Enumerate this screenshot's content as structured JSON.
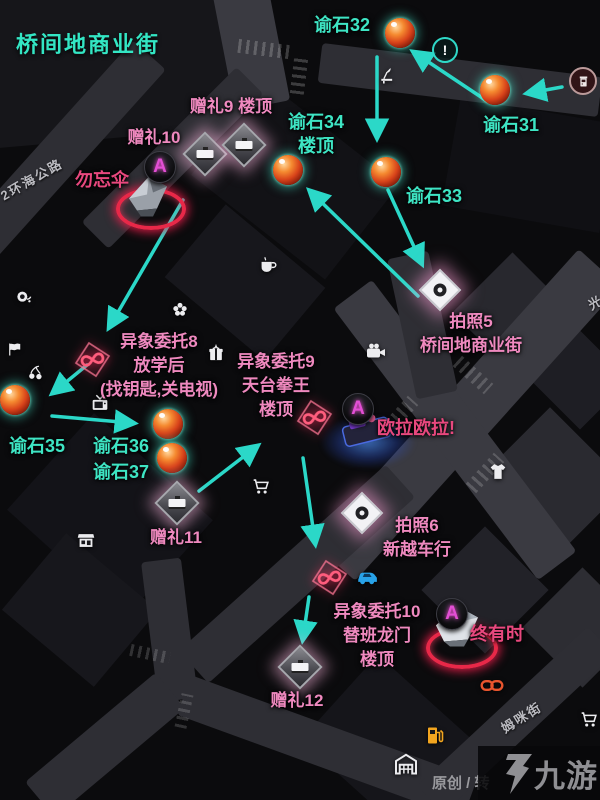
{
  "title": "桥间地商业街",
  "watermark": {
    "credit": "原创 / 转",
    "brand": "九游"
  },
  "colors": {
    "teal": "#3ee5c4",
    "pink": "#ef89bf",
    "rose": "#e8487e",
    "arrow": "#2bd8c8"
  },
  "street_names": [
    {
      "text": "2环海公路",
      "x": 32,
      "y": 180,
      "rotate": -30
    },
    {
      "text": "姆咪街",
      "x": 522,
      "y": 718,
      "rotate": -32
    },
    {
      "text": "光",
      "x": 596,
      "y": 303,
      "rotate": -30
    }
  ],
  "orb_markers": [
    {
      "lines": [
        "谕石31"
      ],
      "orb": {
        "x": 495,
        "y": 90
      },
      "label": {
        "x": 511,
        "y": 125
      }
    },
    {
      "lines": [
        "谕石32"
      ],
      "orb": {
        "x": 400,
        "y": 33
      },
      "label": {
        "x": 342,
        "y": 25
      }
    },
    {
      "lines": [
        "谕石33"
      ],
      "orb": {
        "x": 386,
        "y": 172
      },
      "label": {
        "x": 434,
        "y": 196
      }
    },
    {
      "lines": [
        "谕石34",
        "楼顶"
      ],
      "orb": {
        "x": 288,
        "y": 170
      },
      "label": {
        "x": 316,
        "y": 134
      }
    },
    {
      "lines": [
        "谕石35"
      ],
      "orb": {
        "x": 15,
        "y": 400
      },
      "label": {
        "x": 37,
        "y": 446
      }
    },
    {
      "lines": [
        "谕石36"
      ],
      "orb": {
        "x": 168,
        "y": 424
      },
      "label": {
        "x": 121,
        "y": 446
      }
    },
    {
      "lines": [
        "谕石37"
      ],
      "orb": {
        "x": 172,
        "y": 458
      },
      "label": {
        "x": 121,
        "y": 472
      }
    }
  ],
  "gift_markers": {
    "icons": [
      {
        "x": 205,
        "y": 154
      },
      {
        "x": 244,
        "y": 145
      },
      {
        "x": 177,
        "y": 503
      },
      {
        "x": 300,
        "y": 667
      }
    ],
    "labels": [
      {
        "lines": [
          "赠礼9 楼顶"
        ],
        "x": 231,
        "y": 107
      },
      {
        "lines": [
          "赠礼10"
        ],
        "x": 154,
        "y": 138
      },
      {
        "lines": [
          "赠礼11"
        ],
        "x": 176,
        "y": 538
      },
      {
        "lines": [
          "赠礼12"
        ],
        "x": 297,
        "y": 701
      }
    ]
  },
  "photo_markers": {
    "icons": [
      {
        "x": 440,
        "y": 290
      },
      {
        "x": 362,
        "y": 513
      }
    ],
    "labels": [
      {
        "lines": [
          "拍照5",
          "桥间地商业街"
        ],
        "x": 471,
        "y": 334
      },
      {
        "lines": [
          "拍照6",
          "新越车行"
        ],
        "x": 417,
        "y": 538
      }
    ]
  },
  "anomaly_markers": {
    "icons": [
      {
        "x": 93,
        "y": 362
      },
      {
        "x": 315,
        "y": 420
      },
      {
        "x": 330,
        "y": 580
      }
    ],
    "labels": [
      {
        "lines": [
          "异象委托8",
          "放学后",
          "(找钥匙,关电视)"
        ],
        "x": 159,
        "y": 366
      },
      {
        "lines": [
          "异象委托9",
          "天台拳王",
          "楼顶"
        ],
        "x": 276,
        "y": 386
      },
      {
        "lines": [
          "异象委托10",
          "替班龙门",
          "楼顶"
        ],
        "x": 377,
        "y": 636
      }
    ]
  },
  "characters": [
    {
      "name": "勿忘伞",
      "badge_letter": "A",
      "label": {
        "x": 102,
        "y": 180
      },
      "figure": "umbrella",
      "fig": {
        "x": 150,
        "y": 196
      },
      "badge": {
        "x": 160,
        "y": 167
      },
      "ring": {
        "x": 151,
        "y": 209,
        "w": 62,
        "h": 34,
        "kind": "red"
      }
    },
    {
      "name": "欧拉欧拉!",
      "badge_letter": "A",
      "label": {
        "x": 416,
        "y": 428
      },
      "figure": "couch",
      "fig": {
        "x": 368,
        "y": 436
      },
      "badge": {
        "x": 358,
        "y": 409
      },
      "ring": {
        "x": 368,
        "y": 442,
        "w": 96,
        "h": 54,
        "kind": "blue"
      }
    },
    {
      "name": "终有时",
      "badge_letter": "A",
      "label": {
        "x": 497,
        "y": 634
      },
      "figure": "crystal",
      "fig": {
        "x": 458,
        "y": 627
      },
      "badge": {
        "x": 452,
        "y": 614
      },
      "ring": {
        "x": 462,
        "y": 648,
        "w": 64,
        "h": 34,
        "kind": "red"
      }
    }
  ],
  "pois": [
    {
      "type": "exclaim-icon",
      "x": 445,
      "y": 50
    },
    {
      "type": "arcade-icon",
      "x": 583,
      "y": 81
    },
    {
      "type": "desk-lamp-icon",
      "x": 388,
      "y": 78
    },
    {
      "type": "coffee-icon",
      "x": 268,
      "y": 268
    },
    {
      "type": "flower-icon",
      "x": 180,
      "y": 312
    },
    {
      "type": "gift-box-icon",
      "x": 216,
      "y": 356
    },
    {
      "type": "tv-icon",
      "x": 100,
      "y": 406
    },
    {
      "type": "video-camera-icon",
      "x": 376,
      "y": 354
    },
    {
      "type": "snail-icon",
      "x": 24,
      "y": 300
    },
    {
      "type": "flag-icon",
      "x": 15,
      "y": 352
    },
    {
      "type": "cherry-icon",
      "x": 36,
      "y": 377
    },
    {
      "type": "kiosk-icon",
      "x": 86,
      "y": 543
    },
    {
      "type": "cart-icon",
      "x": 261,
      "y": 489
    },
    {
      "type": "cart-icon",
      "x": 589,
      "y": 722
    },
    {
      "type": "tshirt-icon",
      "x": 498,
      "y": 474
    },
    {
      "type": "car-icon",
      "x": 368,
      "y": 580,
      "color": "#28a2e8"
    },
    {
      "type": "link-icon",
      "x": 492,
      "y": 688,
      "color": "#e8552e"
    },
    {
      "type": "fuel-icon",
      "x": 435,
      "y": 738,
      "color": "#f2a51f"
    },
    {
      "type": "warehouse-icon",
      "x": 406,
      "y": 766
    }
  ],
  "route_arrows": [
    [
      487,
      101,
      415,
      53
    ],
    [
      562,
      87,
      529,
      93
    ],
    [
      377,
      57,
      377,
      136
    ],
    [
      418,
      296,
      311,
      192
    ],
    [
      388,
      190,
      421,
      262
    ],
    [
      183,
      200,
      110,
      326
    ],
    [
      87,
      365,
      54,
      392
    ],
    [
      52,
      416,
      132,
      423
    ],
    [
      199,
      491,
      256,
      447
    ],
    [
      303,
      458,
      315,
      542
    ],
    [
      309,
      597,
      303,
      638
    ]
  ]
}
